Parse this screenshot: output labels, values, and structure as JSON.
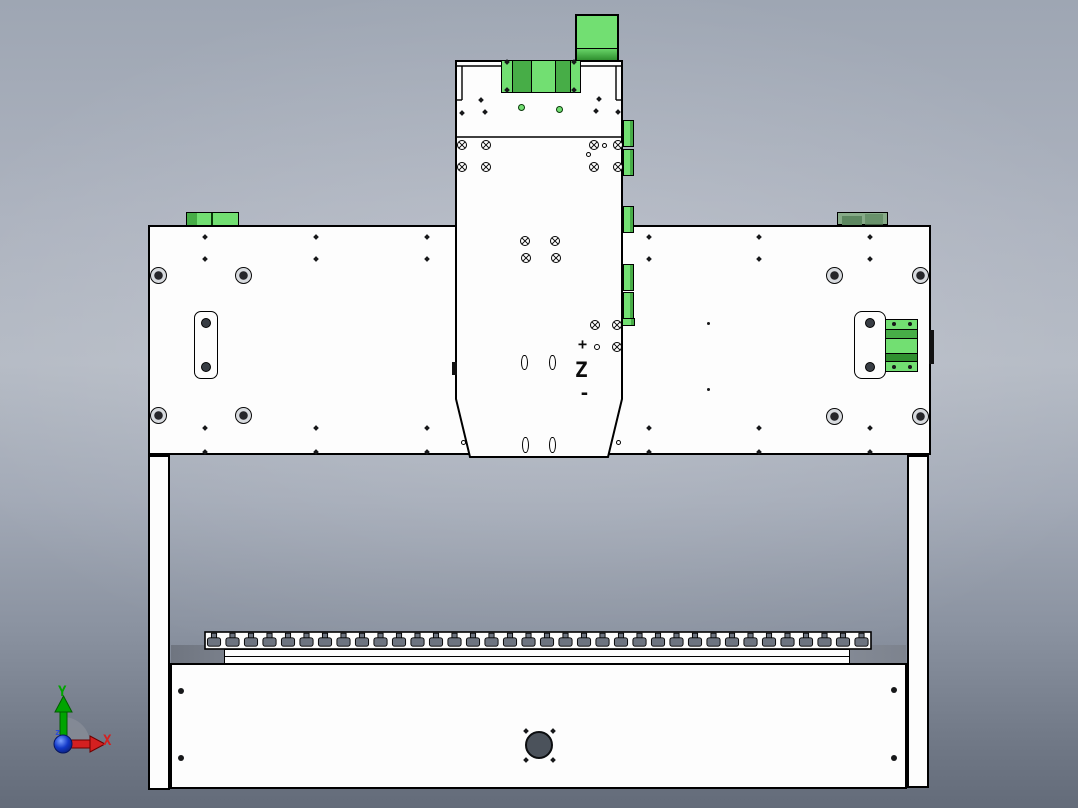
{
  "viewport": {
    "width": 1078,
    "height": 808
  },
  "triad": {
    "x_label": "X",
    "y_label": "Y",
    "z_label": "z"
  },
  "z_axis_annotation": {
    "plus": "+",
    "label": "Z",
    "minus": "-"
  },
  "colors": {
    "green_light": "#72df72",
    "green_mid": "#47ad47",
    "green_dark": "#2f8f2f",
    "green_muted": "#87ab88",
    "green_muted_dark": "#5d8760",
    "outline_black": "#000000",
    "part_white": "#fdfdfd",
    "hole_gray": "#4b525b",
    "shadow_gray": "#79808c",
    "tslot_gray": "#6d7480",
    "axis_red": "#d42020",
    "axis_green": "#00a400",
    "origin_blue": "#1238c8"
  }
}
